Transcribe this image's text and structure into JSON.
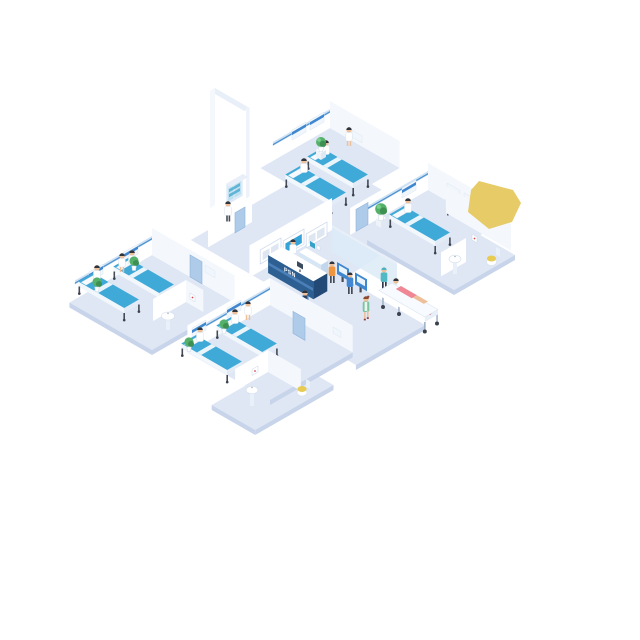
{
  "scene": {
    "description": "Isometric hospital floor illustration with four ward rooms, reception area, check-in kiosks, staff, patients and bathrooms",
    "background_color": "#ffffff",
    "floor_color": "#dfe7f5",
    "wall_color": "#ffffff",
    "accent_blue": "#3fa9d8",
    "reception": {
      "sign": "PSN"
    },
    "rooms": [
      {
        "name": "top ward room",
        "beds": 2,
        "patients": 2,
        "nurses": 1,
        "plants": 1
      },
      {
        "name": "right ward room",
        "beds": 1,
        "patients": 1,
        "doctors": 1,
        "plants": 1
      },
      {
        "name": "left ward room",
        "beds": 2,
        "patients": 2,
        "nurses": 1,
        "plants": 2
      },
      {
        "name": "bottom ward room",
        "beds": 2,
        "patients": 2,
        "nurses": 1,
        "plants": 2
      }
    ],
    "corridor_people": [
      "receptionist",
      "staff at medicine cabinet",
      "kiosk user in orange",
      "kiosk user in blue",
      "walking man in blue",
      "walking nurse in green",
      "nurse pushing stretcher",
      "patient on stretcher",
      "doctor"
    ],
    "objects": [
      "reception desk",
      "wall-mounted screens",
      "check-in kiosks",
      "medicine cabinet",
      "stretcher",
      "potted plants",
      "bathroom sinks",
      "toilets",
      "tall wall"
    ],
    "highlight": {
      "shape": "yellow polygon",
      "color": "#e7cb66"
    }
  }
}
